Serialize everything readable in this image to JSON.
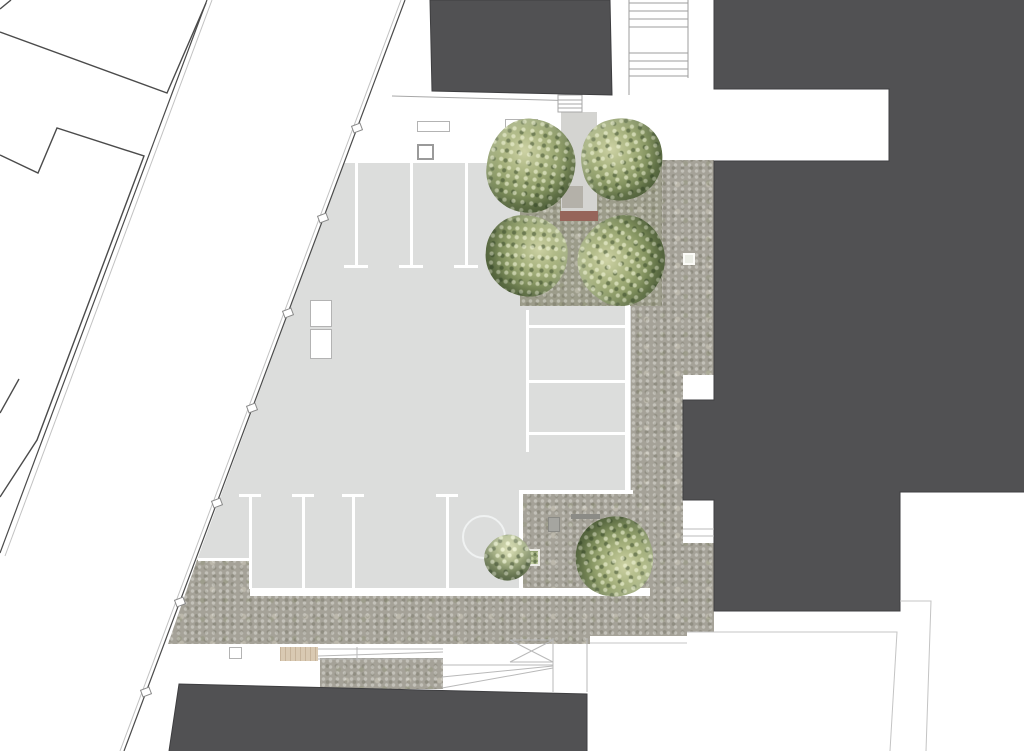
{
  "plan": {
    "kind": "architectural site plan, top view, no text labels",
    "colors": {
      "background": "#ffffff",
      "plaza": "#dcdddc",
      "gravel": "#a5a298",
      "grove": "#9c9c8a",
      "building": "#515153",
      "line_dark": "#4b4b4b",
      "line_light": "#c2c2c2",
      "marking": "#ffffff",
      "tree_light": "#cdd2a4",
      "tree_mid": "#83935f",
      "tree_dark": "#526442",
      "bench_red": "#96655a",
      "bench_wood": "#d9c9b2",
      "planter_green": "#93a273"
    },
    "areas": {
      "plaza": "light-gray paved plaza with painted parking stalls",
      "gravel": "textured gravel surface along right building and bottom edge",
      "grove": "gravel square with four large trees and central path",
      "street": "diagonal street with curb lines and posts at lower left",
      "outlined_buildings": "neighboring buildings drawn in outline only, upper left"
    },
    "counts": {
      "dark_buildings": 3,
      "trees_large": 5,
      "trees_small": 1,
      "parking_lines_top": 3,
      "parking_lines_right": 3,
      "parking_lines_bottom": 4,
      "street_posts": 7,
      "planters_green": 3,
      "benches": 2
    }
  }
}
